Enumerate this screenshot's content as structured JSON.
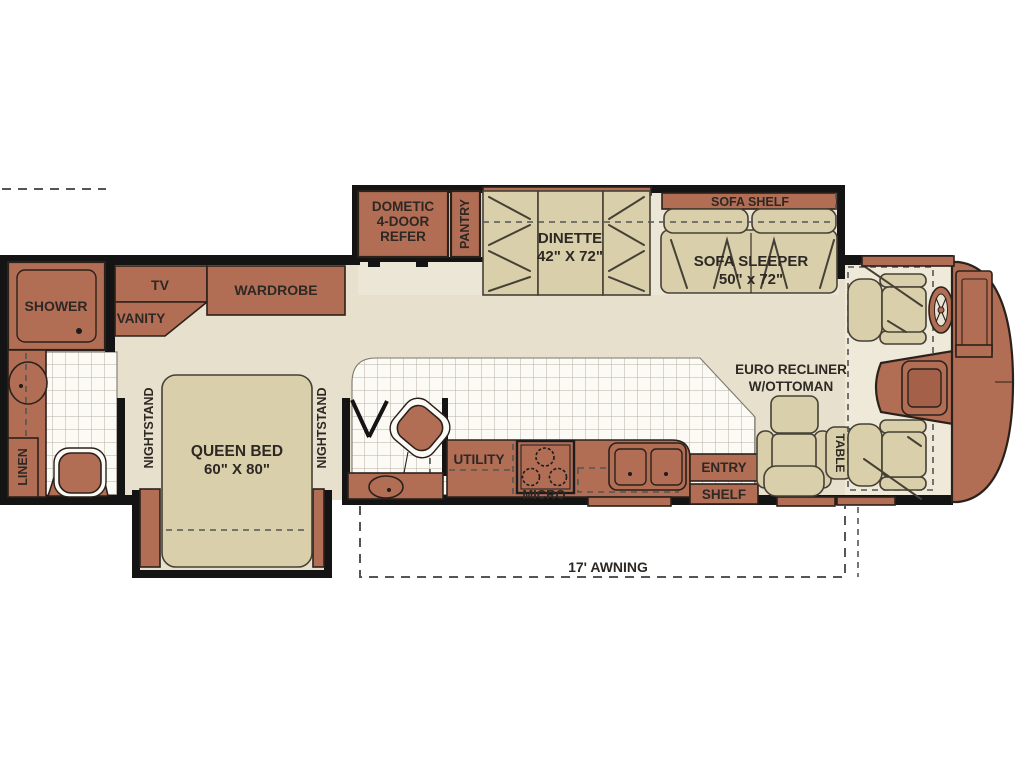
{
  "title": "Motorhome floor plan",
  "colors": {
    "cabinet_brown": "#b26d55",
    "furniture_beige": "#d9d0ab",
    "floor_beige": "#e7e0cc",
    "slide_floor": "#ece6d7",
    "cockpit_floor": "#efe9da",
    "tile_white": "#fcfaf5",
    "wall_black": "#141414",
    "label_text": "#2d2823",
    "background": "#ffffff"
  },
  "labels": {
    "shower": "SHOWER",
    "tv": "TV",
    "vanity": "VANITY",
    "wardrobe": "WARDROBE",
    "linen": "LINEN",
    "nightstand_left": "NIGHTSTAND",
    "nightstand_right": "NIGHTSTAND",
    "queen_bed_line1": "QUEEN BED",
    "queen_bed_line2": "60\" X 80\"",
    "refer_line1": "DOMETIC",
    "refer_line2": "4-DOOR",
    "refer_line3": "REFER",
    "pantry": "PANTRY",
    "dinette_line1": "DINETTE",
    "dinette_line2": "42\" X 72\"",
    "sofa_shelf": "SOFA SHELF",
    "sofa_line1": "SOFA SLEEPER",
    "sofa_line2": "50\" x 72\"",
    "euro_recliner_line1": "EURO RECLINER",
    "euro_recliner_line2": "W/OTTOMAN",
    "utility": "UTILITY",
    "micro": "MICRO",
    "entry": "ENTRY",
    "shelf": "SHELF",
    "table": "TABLE",
    "awning": "17' AWNING"
  }
}
